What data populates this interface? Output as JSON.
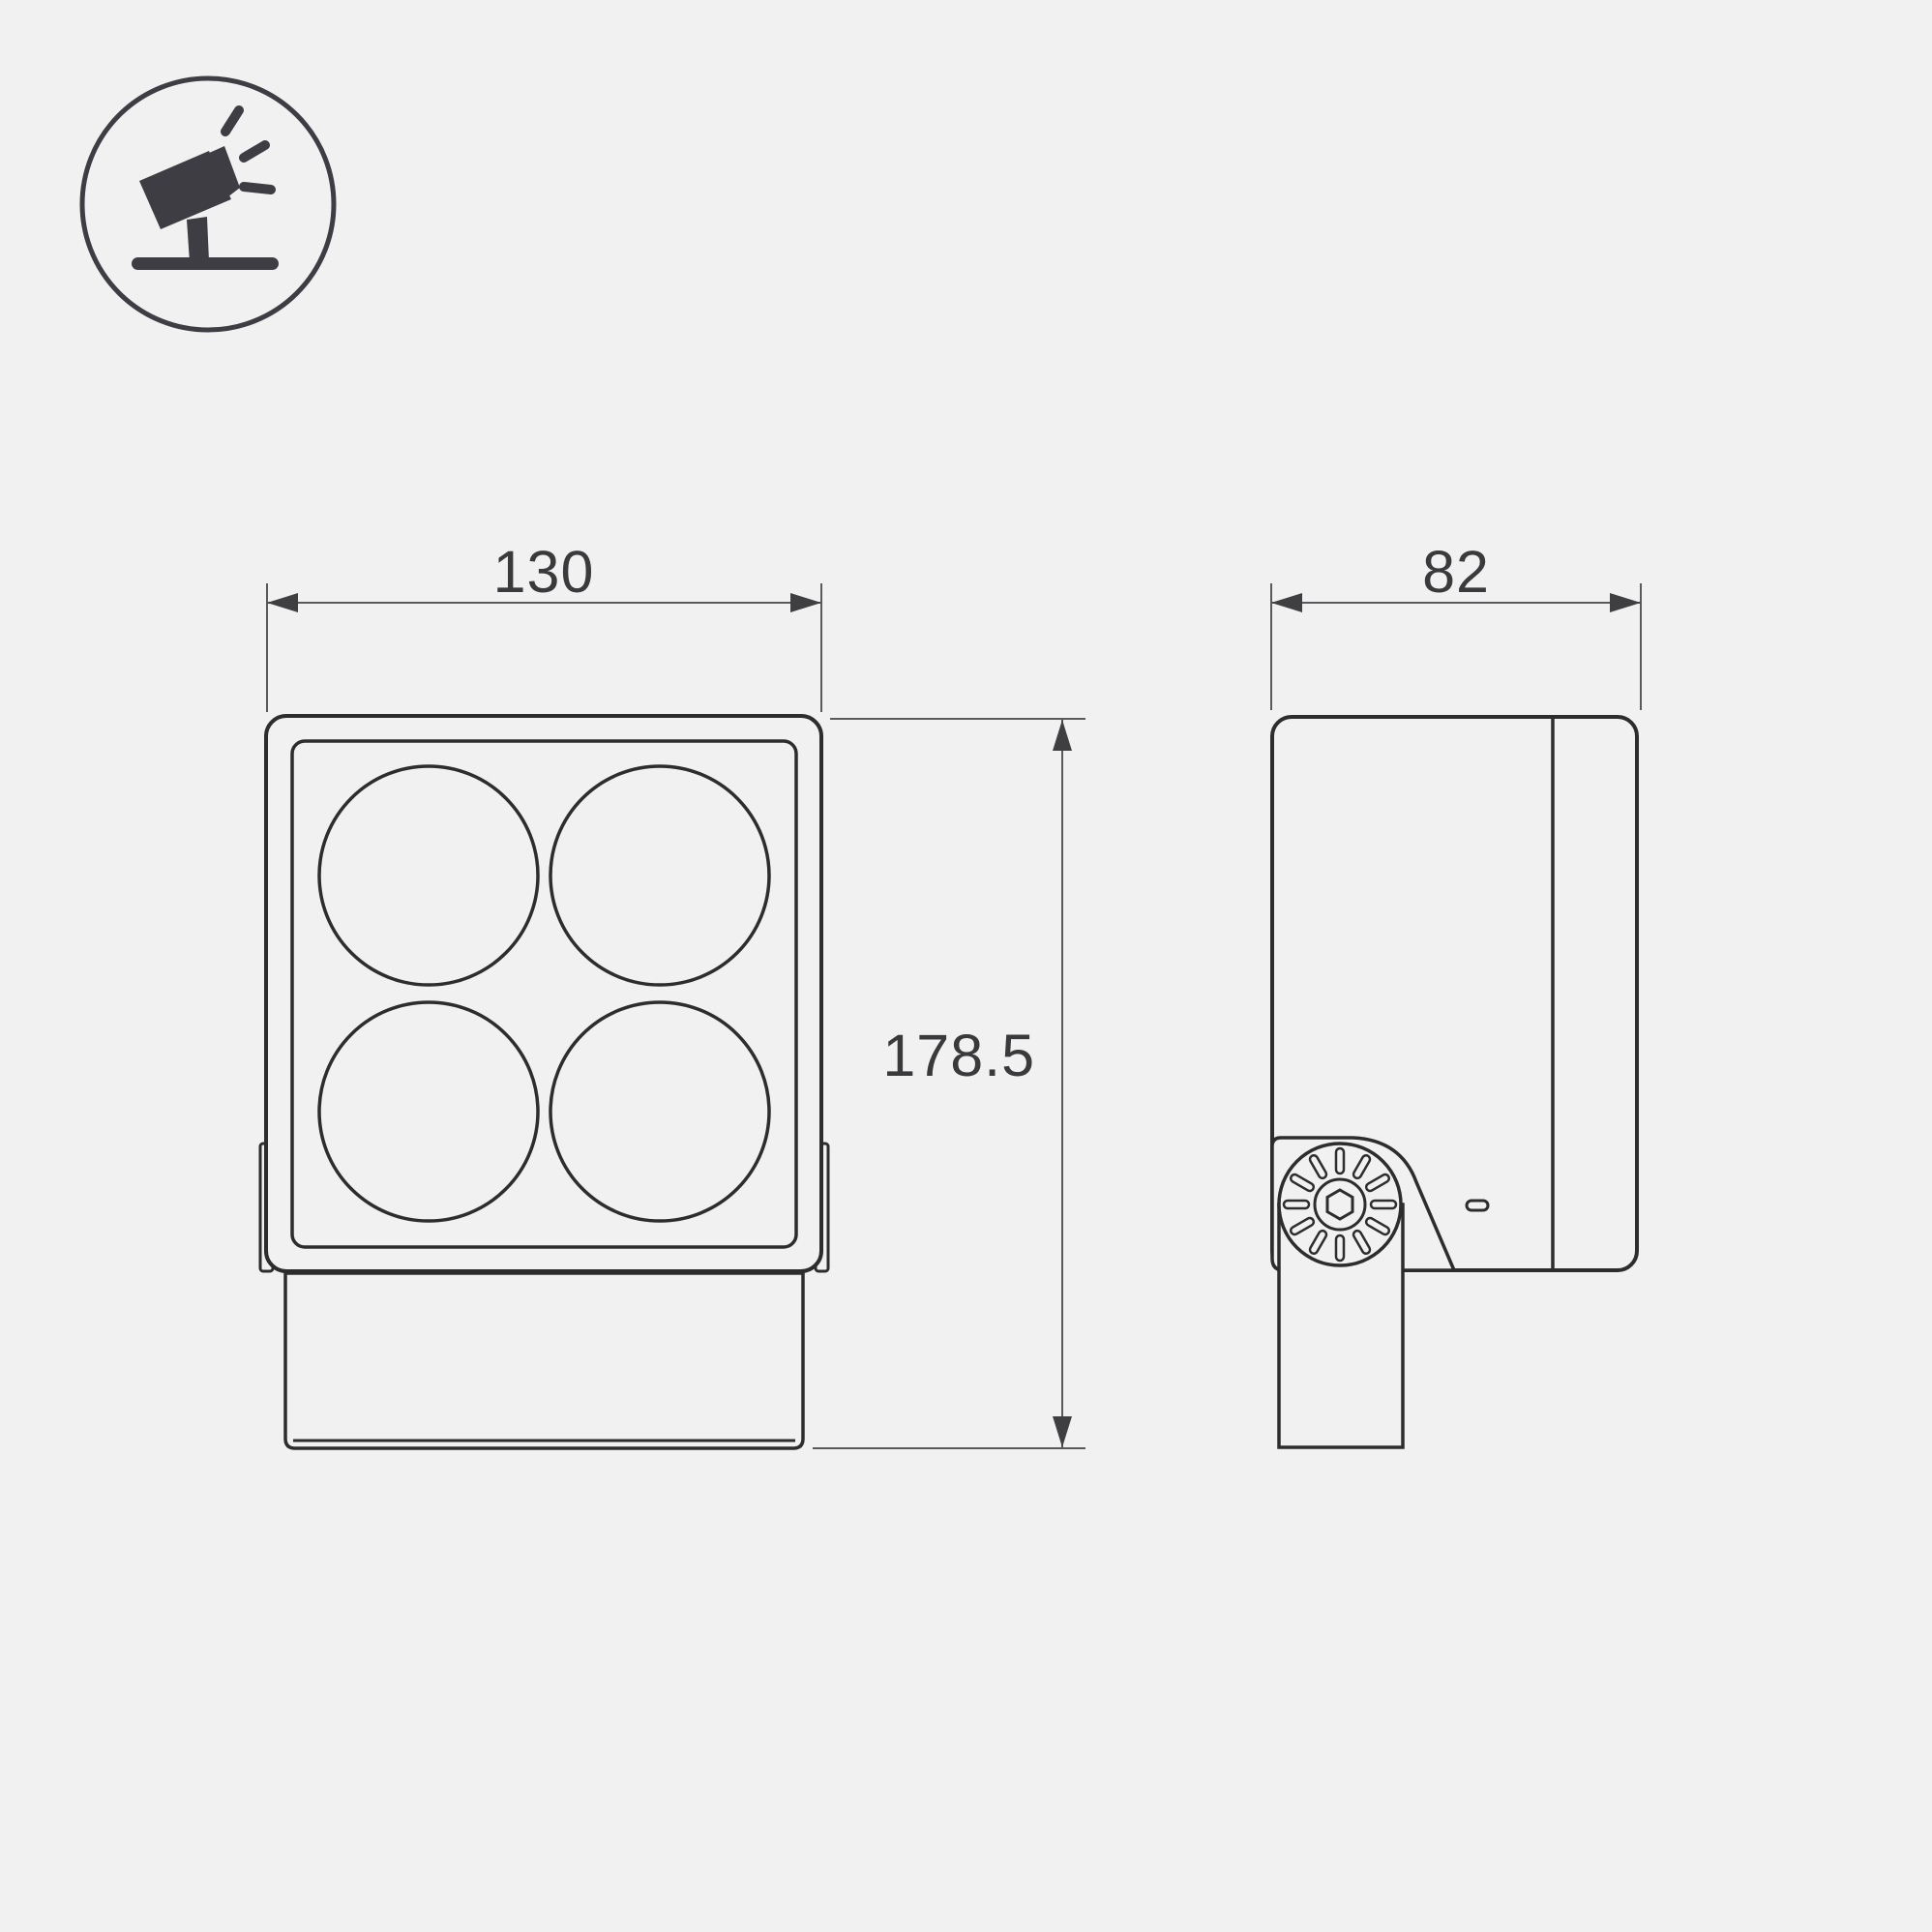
{
  "page": {
    "type": "technical-dimension-drawing",
    "subject": "LED floodlight with four round lenses on adjustable mounting bracket",
    "background_color": "#f1f1f1",
    "outline_color": "#2d2d2d",
    "dimension_line_color": "#5a5a5c",
    "text_color": "#3a3a3c"
  },
  "icon": {
    "name": "tilted-floodlight-on-stand",
    "description": "circular pictogram of a floodlight on a ground stand emitting light rays"
  },
  "views": {
    "front": {
      "label": "front view",
      "lens_count": 4
    },
    "side": {
      "label": "side view",
      "features": [
        "rear cap line",
        "adjustment knob with radial knurling",
        "hex socket",
        "mounting arm",
        "indicator slot"
      ]
    }
  },
  "dimensions": {
    "width": "130",
    "height": "178.5",
    "depth": "82"
  }
}
